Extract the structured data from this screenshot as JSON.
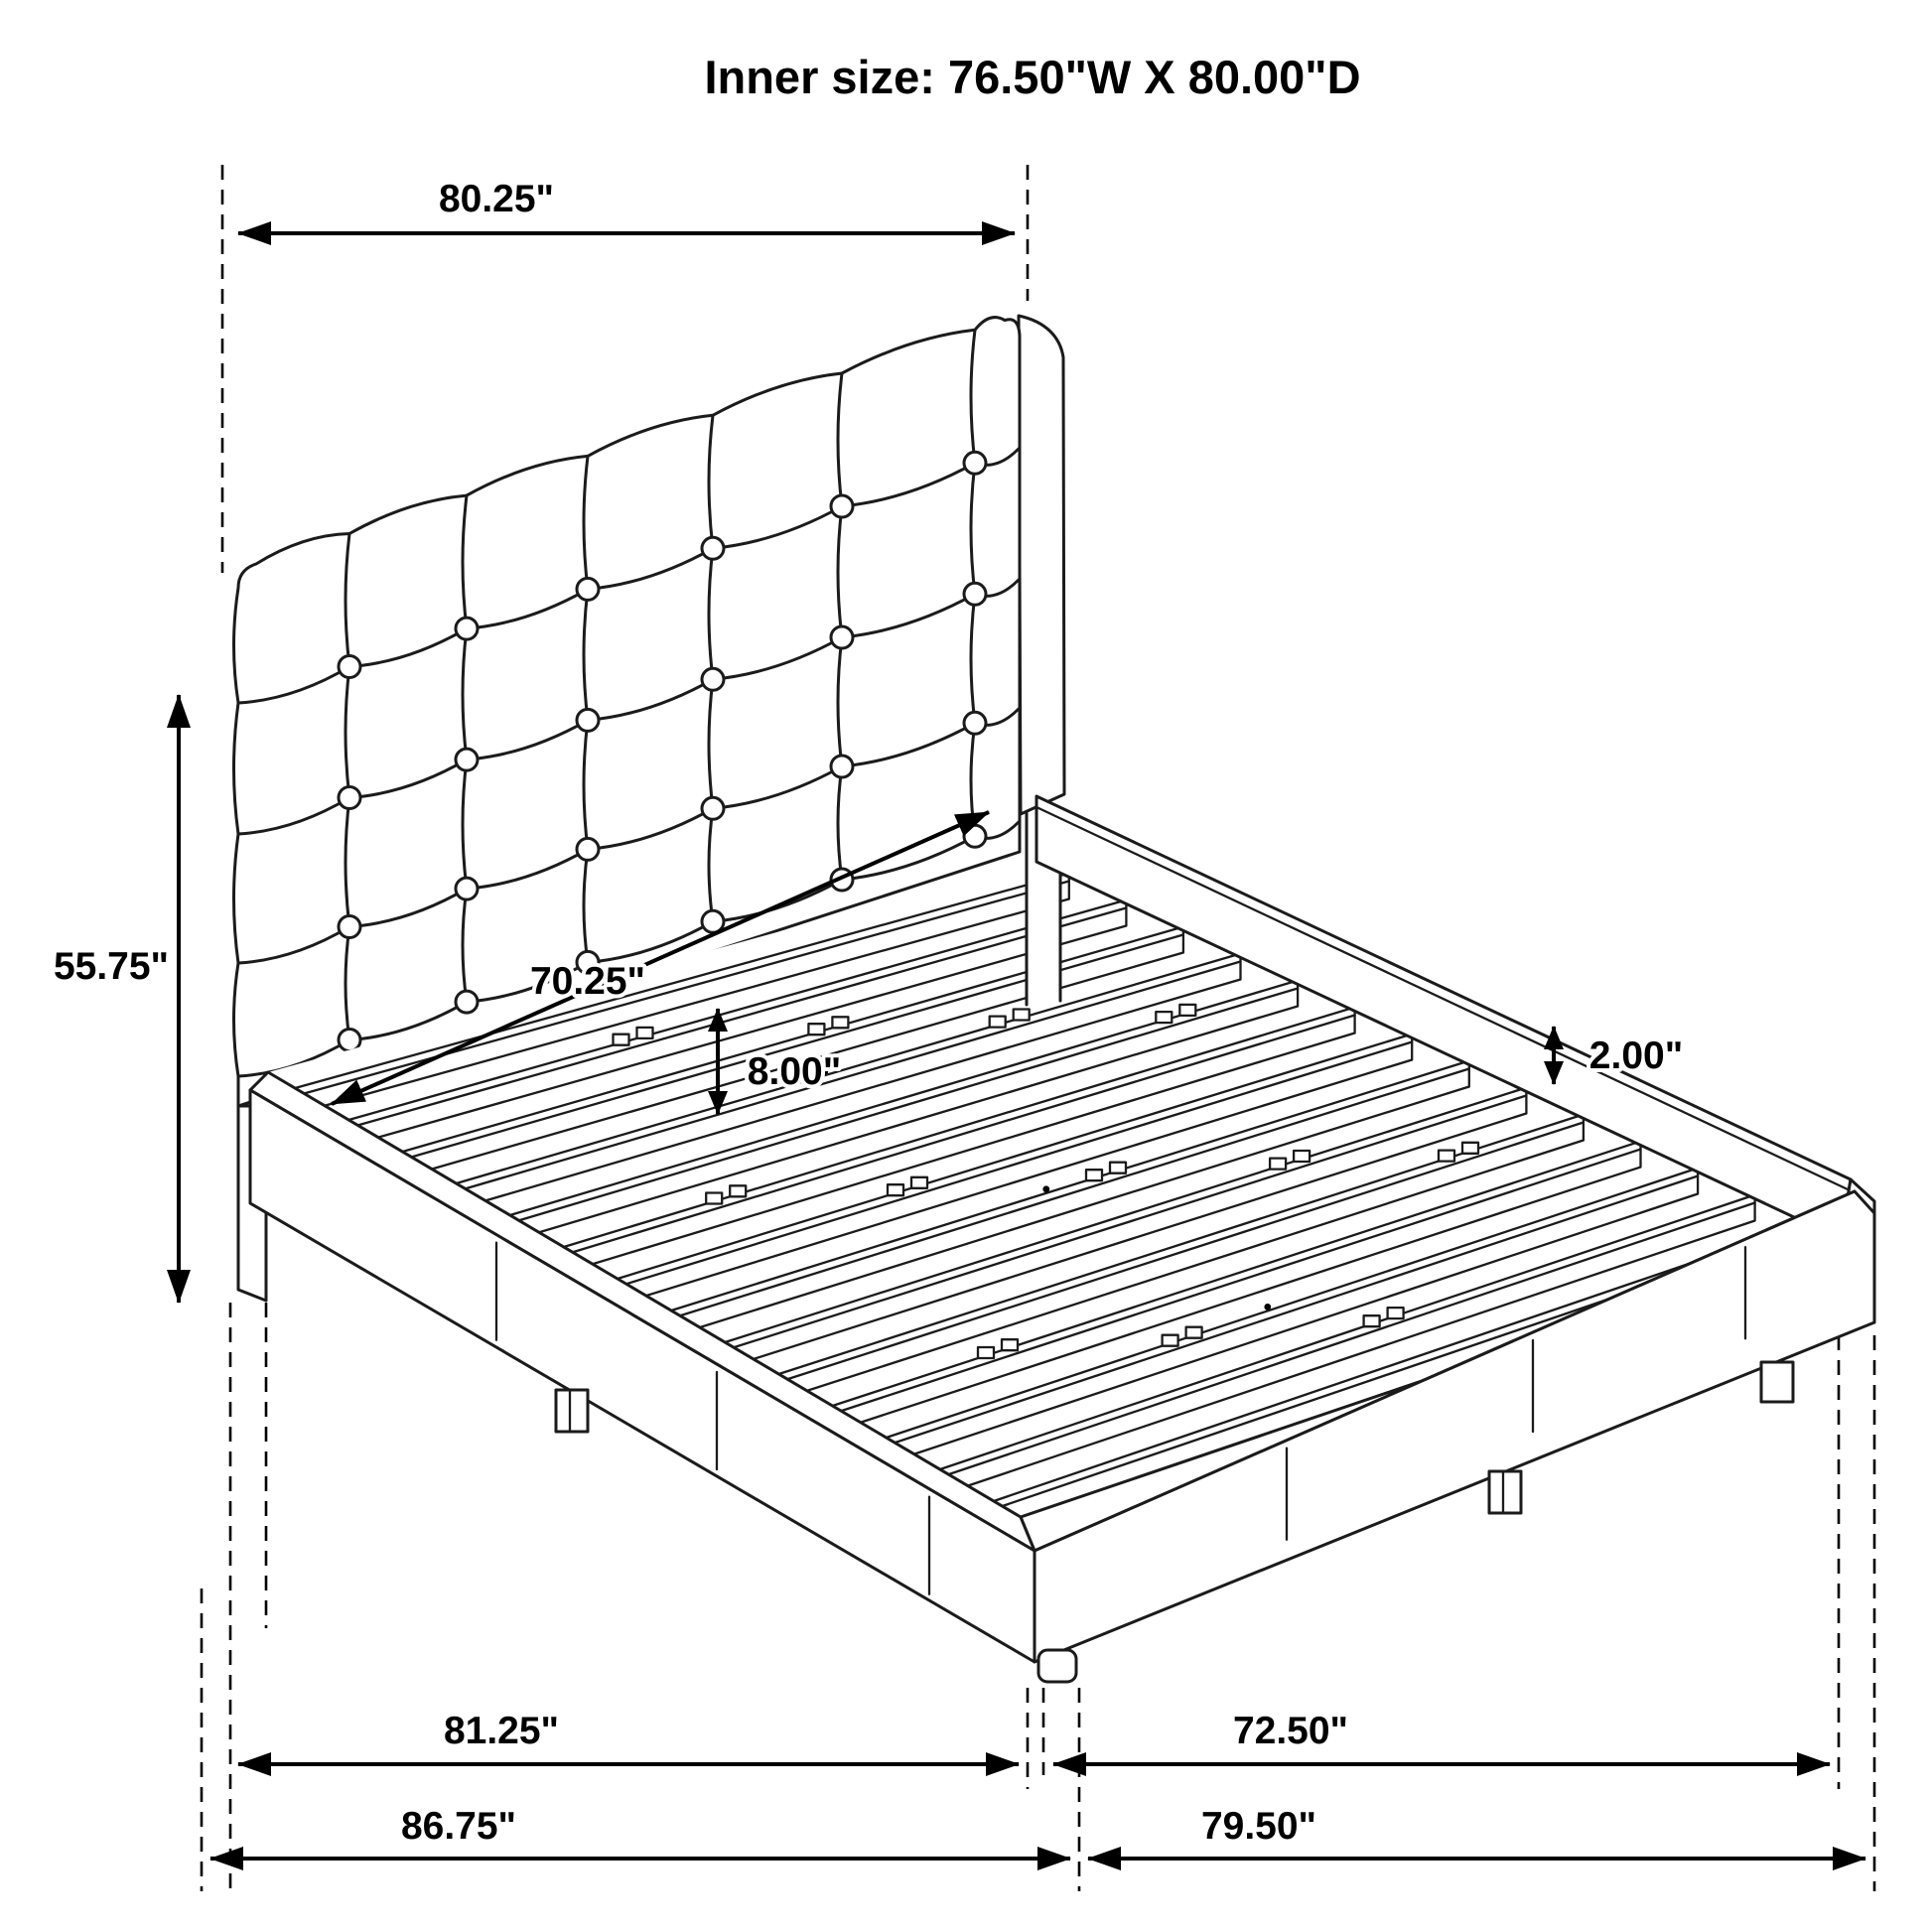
{
  "title": "Inner size: 76.50\"W X 80.00\"D",
  "diagram": {
    "subject": "upholstered-platform-bed-with-tufted-headboard",
    "style": "black-outline-technical-drawing"
  },
  "colors": {
    "line": "#1b1b1b",
    "dimension": "#000000",
    "background": "#ffffff"
  },
  "dimensions": {
    "top_width": "80.25\"",
    "headboard_height": "55.75\"",
    "inner_diagonal_width": "70.25\"",
    "deck_height": "8.00\"",
    "rail_thickness": "2.00\"",
    "base_length_inner": "81.25\"",
    "base_width_inner": "72.50\"",
    "overall_length": "86.75\"",
    "overall_width": "79.50\""
  }
}
